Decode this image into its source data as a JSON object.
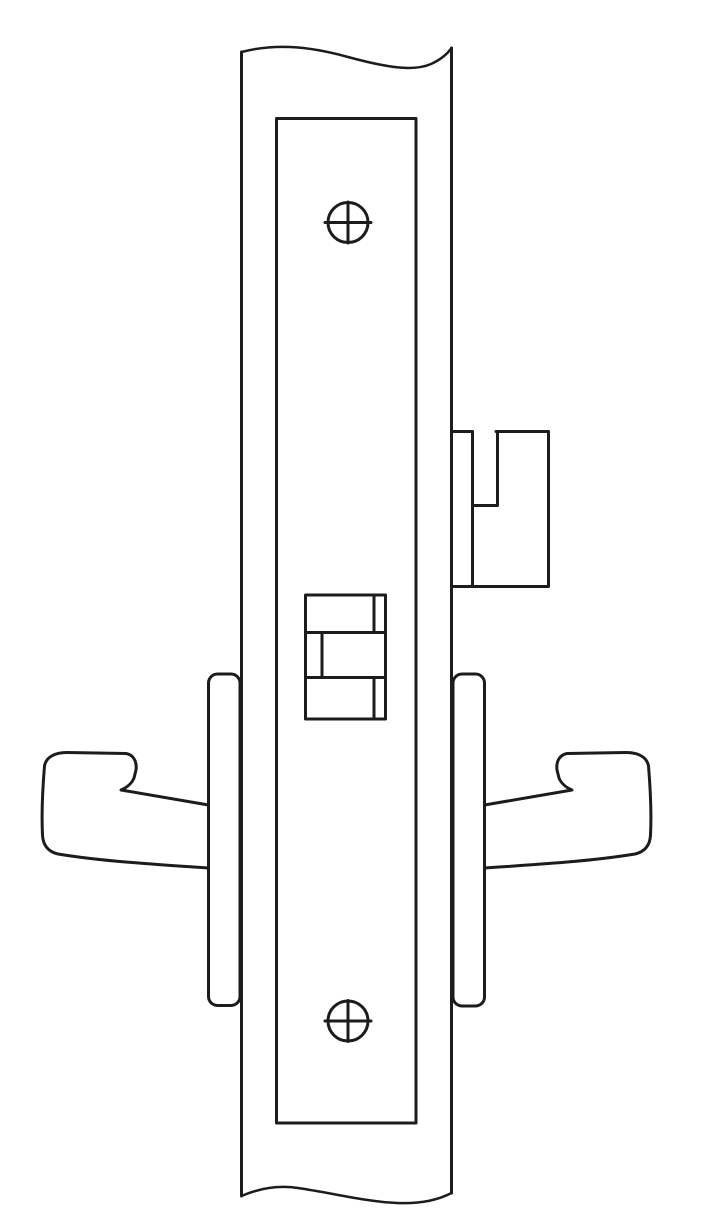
{
  "figure": {
    "description": "Technical line drawing of a mortise lock (front view) installed in a door edge, shown with break lines, faceplate, two mounting screws, latchbolt with anti-friction piece, stop-works block, and lever handles with roses on both sides",
    "background_color": "#ffffff",
    "line_color": "#1c1c1c",
    "stroke_width": "3",
    "parts": {
      "door_edge": "door edge strip with wavy break lines top and bottom",
      "faceplate": "mortise lock faceplate",
      "top_screw": "top phillips mounting screw",
      "bottom_screw": "bottom phillips mounting screw",
      "latchbolt": "latchbolt with anti-friction trigger protruding right",
      "stop_works": "stop-works / auxiliary bolt block on faceplate",
      "left_rose": "left rose plate",
      "right_rose": "right rose plate",
      "left_lever": "left lever handle",
      "right_lever": "right lever handle"
    }
  }
}
